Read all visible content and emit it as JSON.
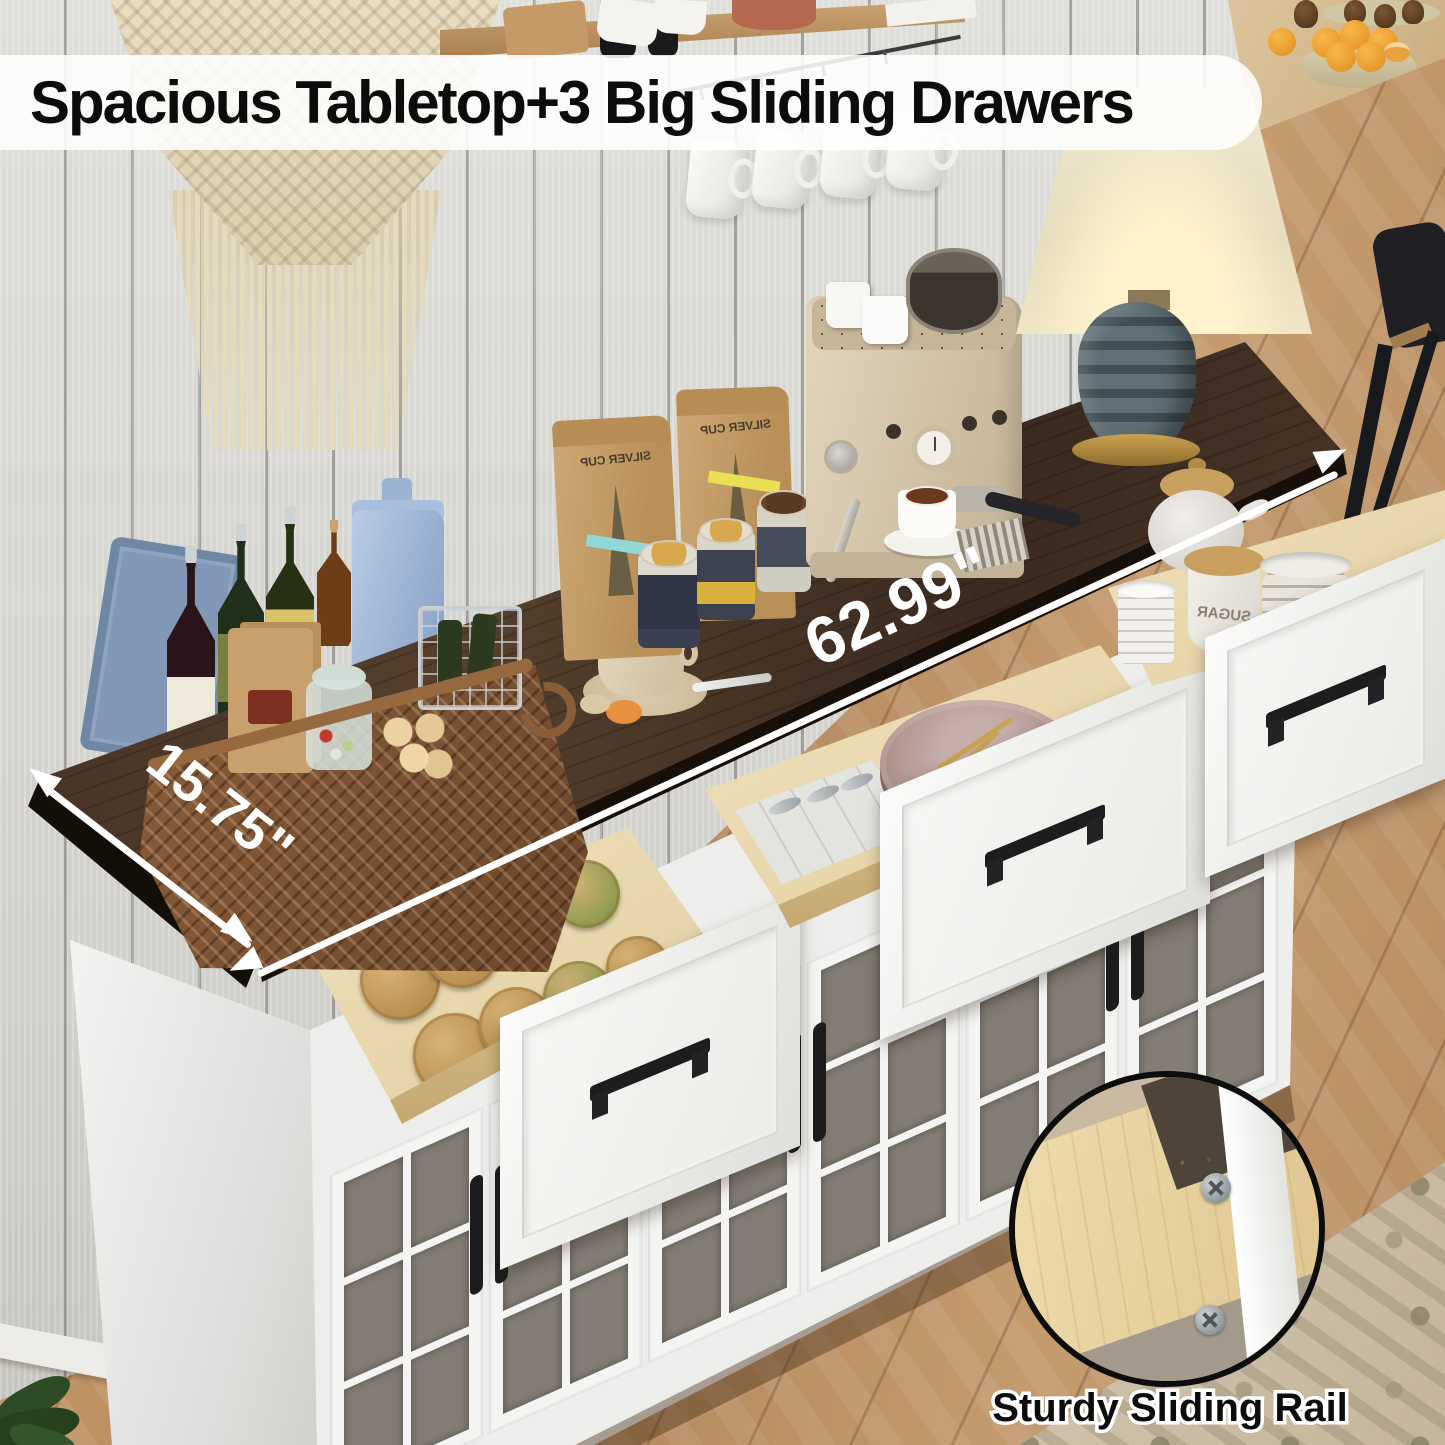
{
  "banner": {
    "headline": "Spacious Tabletop+3 Big Sliding Drawers",
    "background": "rgba(255,255,255,0.87)",
    "text_color": "#0c0c0c"
  },
  "measurements": {
    "tabletop_width": "62.99\"",
    "tabletop_depth": "15.75\"",
    "annotation_color": "#ffffff"
  },
  "inset": {
    "caption": "Sturdy Sliding Rail"
  },
  "labels": {
    "coffee_bag_brand": "SILVER CUP",
    "sugar_jar": "SUGAR"
  },
  "colors": {
    "tabletop": "#3b2b21",
    "cabinet_white": "#f3f3f1",
    "drawer_wood": "#e8d7b0",
    "handle_black": "#1c1c1e",
    "wall": "#d8d7d3",
    "floor_wood": "#bc8f63"
  }
}
